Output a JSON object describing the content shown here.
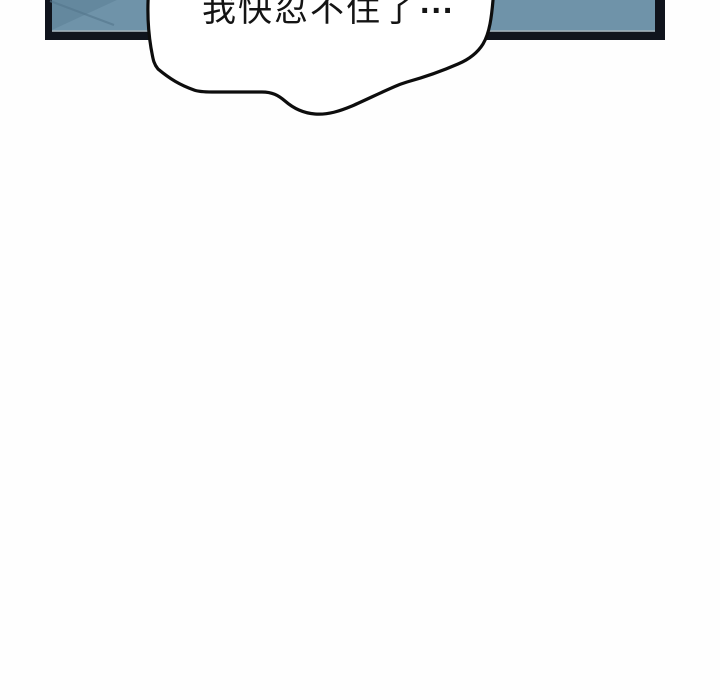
{
  "page": {
    "background_color": "#ffffff"
  },
  "panel": {
    "description_colors": "blue classroom-board panel cut off at top of frame",
    "fill_color": "#6f93a9",
    "border_color": "#10141d",
    "shade_color": "#55788e",
    "highlight_line_color": "#bcc3c7"
  },
  "bubble": {
    "fill_color": "#ffffff",
    "outline_color": "#0d0d0d",
    "text": "我快忍不住了",
    "ellipsis": "...",
    "text_color": "#141414"
  }
}
